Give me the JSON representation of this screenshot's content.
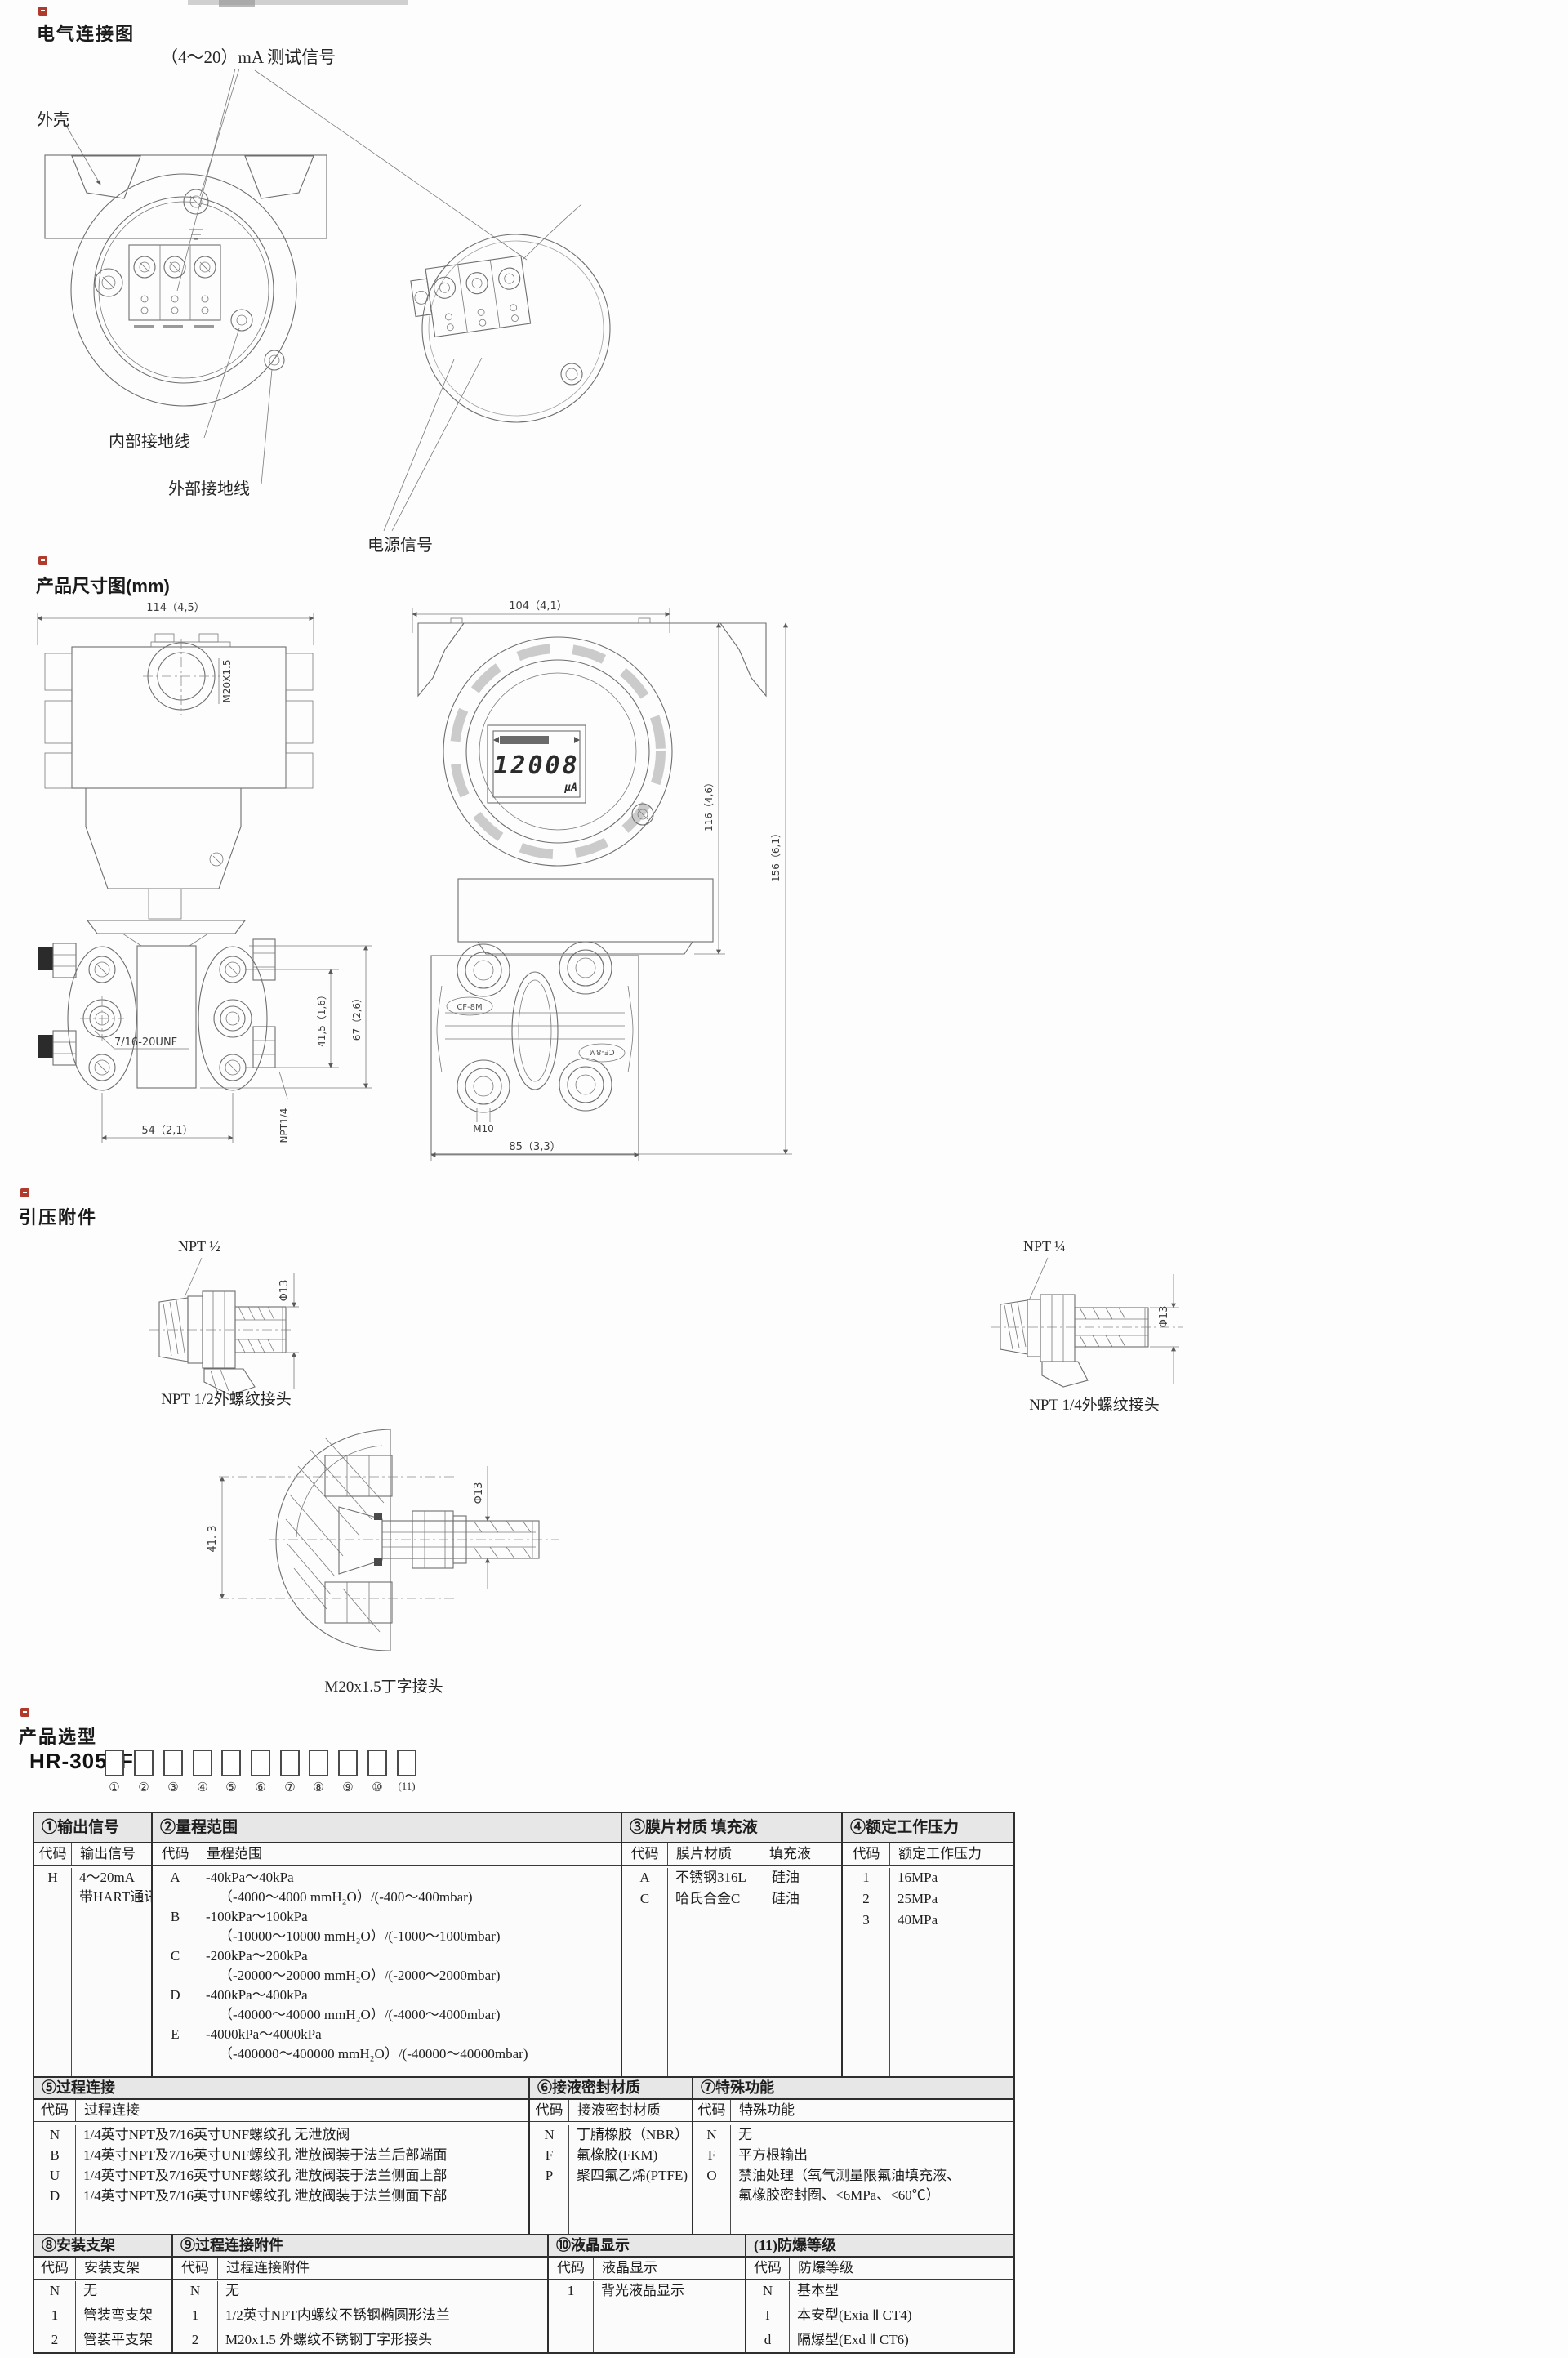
{
  "page": {
    "bg": "#fdfdfd"
  },
  "colors": {
    "accent_red": "#b03a2c",
    "line": "#6e6e6e",
    "table_border": "#2e2e2e",
    "header_bg": "#e7e7e7"
  },
  "electrical": {
    "title": "电气连接图",
    "test_signal_label": "（4～20）mA 测试信号",
    "housing_label": "外壳",
    "internal_ground_label": "内部接地线",
    "external_ground_label": "外部接地线",
    "power_signal_label": "电源信号"
  },
  "dimensions": {
    "title": "产品尺寸图(mm)",
    "front_view": {
      "width_dim": "114（4,5）",
      "conduit_thread": "M20X1.5",
      "flange_thread": "7/16-20UNF",
      "bolt_span_dim": "41,5（1,6）",
      "flange_height_dim": "67（2,6）",
      "port_span_dim": "54（2,1）",
      "drain_thread": "NPT1/4"
    },
    "side_view": {
      "width_dim": "104（4,1）",
      "lcd_value": "12008",
      "lcd_unit": "µA",
      "height_dim": "116（4,6）",
      "total_height_dim": "156（6,1）",
      "stamp_left": "CF-8M",
      "stamp_right": "CF-8M",
      "bolt_thread": "M10",
      "flange_width_dim": "85（3,3）"
    }
  },
  "fittings": {
    "title": "引压附件",
    "npt_half": {
      "thread_label": "NPT ½",
      "dia_dim": "Φ13",
      "caption": "NPT 1/2外螺纹接头"
    },
    "npt_quarter": {
      "thread_label": "NPT ¼",
      "dia_dim": "Φ13",
      "caption": "NPT 1/4外螺纹接头"
    },
    "m20_tee": {
      "offset_dim": "41. 3",
      "dia_dim": "Φ13",
      "caption": "M20x1.5丁字接头"
    }
  },
  "selection": {
    "title": "产品选型",
    "model_prefix": "HR-3051F1-",
    "positions": [
      "①",
      "②",
      "③",
      "④",
      "⑤",
      "⑥",
      "⑦",
      "⑧",
      "⑨",
      "⑩",
      "(11)"
    ],
    "s1": {
      "no": "①",
      "name": "输出信号",
      "code_h": "代码",
      "label_h": "输出信号",
      "rows": [
        {
          "code": "H",
          "l1": "4～20mA",
          "l2": "带HART通讯"
        }
      ]
    },
    "s2": {
      "no": "②",
      "name": "量程范围",
      "code_h": "代码",
      "label_h": "量程范围",
      "rows": [
        {
          "code": "A",
          "l1": "-40kPa～40kPa",
          "l2": "（-4000～4000 mmH₂O）/(-400～400mbar)"
        },
        {
          "code": "B",
          "l1": "-100kPa～100kPa",
          "l2": "（-10000～10000 mmH₂O）/(-1000～1000mbar)"
        },
        {
          "code": "C",
          "l1": "-200kPa～200kPa",
          "l2": "（-20000～20000 mmH₂O）/(-2000～2000mbar)"
        },
        {
          "code": "D",
          "l1": "-400kPa～400kPa",
          "l2": "（-40000～40000 mmH₂O）/(-4000～4000mbar)"
        },
        {
          "code": "E",
          "l1": "-4000kPa～4000kPa",
          "l2": "（-400000～400000 mmH₂O）/(-40000～40000mbar)"
        }
      ]
    },
    "s3": {
      "no": "③",
      "name": "膜片材质  填充液",
      "code_h": "代码",
      "label_h": "膜片材质",
      "label2_h": "填充液",
      "rows": [
        {
          "code": "A",
          "material": "不锈钢316L",
          "fill": "硅油"
        },
        {
          "code": "C",
          "material": "哈氏合金C",
          "fill": "硅油"
        }
      ]
    },
    "s4": {
      "no": "④",
      "name": "额定工作压力",
      "code_h": "代码",
      "label_h": "额定工作压力",
      "rows": [
        {
          "code": "1",
          "label": "16MPa"
        },
        {
          "code": "2",
          "label": "25MPa"
        },
        {
          "code": "3",
          "label": "40MPa"
        }
      ]
    },
    "s5": {
      "no": "⑤",
      "name": "过程连接",
      "code_h": "代码",
      "label_h": "过程连接",
      "rows": [
        {
          "code": "N",
          "label": "1/4英寸NPT及7/16英寸UNF螺纹孔 无泄放阀"
        },
        {
          "code": "B",
          "label": "1/4英寸NPT及7/16英寸UNF螺纹孔 泄放阀装于法兰后部端面"
        },
        {
          "code": "U",
          "label": "1/4英寸NPT及7/16英寸UNF螺纹孔 泄放阀装于法兰侧面上部"
        },
        {
          "code": "D",
          "label": "1/4英寸NPT及7/16英寸UNF螺纹孔 泄放阀装于法兰侧面下部"
        }
      ]
    },
    "s6": {
      "no": "⑥",
      "name": "接液密封材质",
      "code_h": "代码",
      "label_h": "接液密封材质",
      "rows": [
        {
          "code": "N",
          "label": "丁腈橡胶（NBR）"
        },
        {
          "code": "F",
          "label": "氟橡胶(FKM)"
        },
        {
          "code": "P",
          "label": "聚四氟乙烯(PTFE)"
        }
      ]
    },
    "s7": {
      "no": "⑦",
      "name": "特殊功能",
      "code_h": "代码",
      "label_h": "特殊功能",
      "rows": [
        {
          "code": "N",
          "label": "无"
        },
        {
          "code": "F",
          "label": "平方根输出"
        },
        {
          "code": "O",
          "l1": "禁油处理（氧气测量限氟油填充液、",
          "l2": "氟橡胶密封圈、<6MPa、<60℃）"
        }
      ]
    },
    "s8": {
      "no": "⑧",
      "name": "安装支架",
      "code_h": "代码",
      "label_h": "安装支架",
      "rows": [
        {
          "code": "N",
          "label": "无"
        },
        {
          "code": "1",
          "label": "管装弯支架"
        },
        {
          "code": "2",
          "label": "管装平支架"
        }
      ]
    },
    "s9": {
      "no": "⑨",
      "name": "过程连接附件",
      "code_h": "代码",
      "label_h": "过程连接附件",
      "rows": [
        {
          "code": "N",
          "label": "无"
        },
        {
          "code": "1",
          "label": "1/2英寸NPT内螺纹不锈钢椭圆形法兰"
        },
        {
          "code": "2",
          "label": "M20x1.5 外螺纹不锈钢丁字形接头"
        }
      ]
    },
    "s10": {
      "no": "⑩",
      "name": "液晶显示",
      "code_h": "代码",
      "label_h": "液晶显示",
      "rows": [
        {
          "code": "1",
          "label": "背光液晶显示"
        }
      ]
    },
    "s11": {
      "no": "(11)",
      "name": "防爆等级",
      "code_h": "代码",
      "label_h": "防爆等级",
      "rows": [
        {
          "code": "N",
          "label": "基本型"
        },
        {
          "code": "I",
          "label": "本安型(Exia Ⅱ CT4)"
        },
        {
          "code": "d",
          "label": "隔爆型(Exd Ⅱ CT6)"
        }
      ]
    }
  }
}
